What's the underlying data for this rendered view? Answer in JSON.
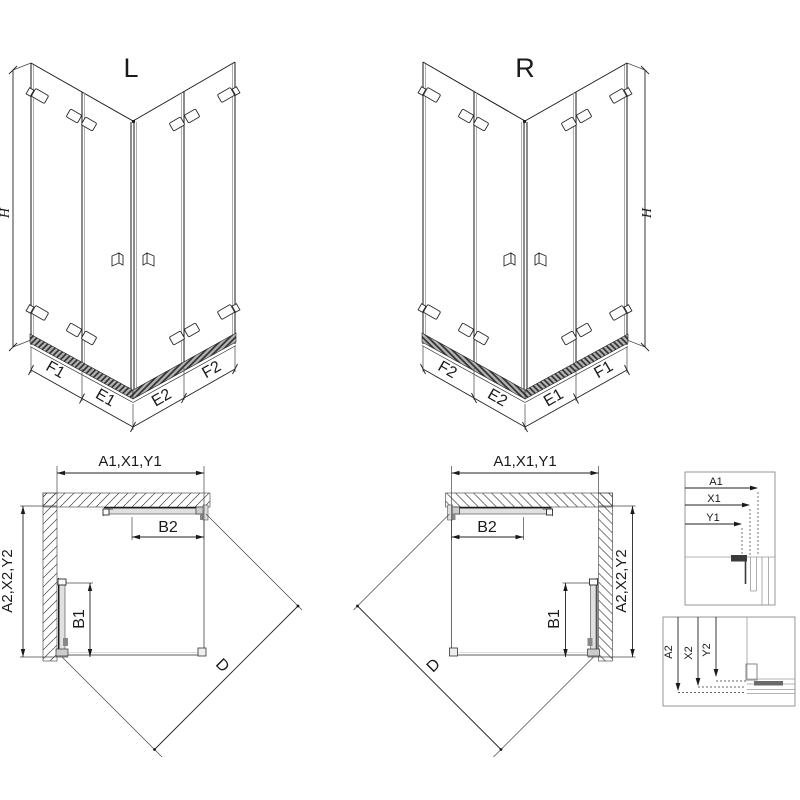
{
  "variants": {
    "left": "L",
    "right": "R"
  },
  "height_label": "H",
  "iso_left_segments": {
    "outer_left": "F1",
    "inner_left": "E1",
    "inner_right": "E2",
    "outer_right": "F2"
  },
  "iso_right_segments": {
    "outer_left": "F2",
    "inner_left": "E2",
    "inner_right": "E1",
    "outer_right": "F1"
  },
  "plan_left": {
    "width_dim": "A1,X1,Y1",
    "depth_dim": "A2,X2,Y2",
    "door_top": "B2",
    "door_side": "B1",
    "diagonal": "D"
  },
  "plan_right": {
    "width_dim": "A1,X1,Y1",
    "depth_dim": "A2,X2,Y2",
    "door_top": "B2",
    "door_side": "B1",
    "diagonal": "D"
  },
  "detail_width": {
    "dim1": "A1",
    "dim2": "X1",
    "dim3": "Y1"
  },
  "detail_depth": {
    "dim1": "A2",
    "dim2": "X2",
    "dim3": "Y2"
  },
  "colors": {
    "line": "#1a1a1a",
    "dim_line": "#222222",
    "profile_gray": "#8c8c8c",
    "panel_fill": "#e0e0e0",
    "dark_fill": "#3a3a3a",
    "rail_fill": "#b5b5b5",
    "background": "#ffffff"
  }
}
